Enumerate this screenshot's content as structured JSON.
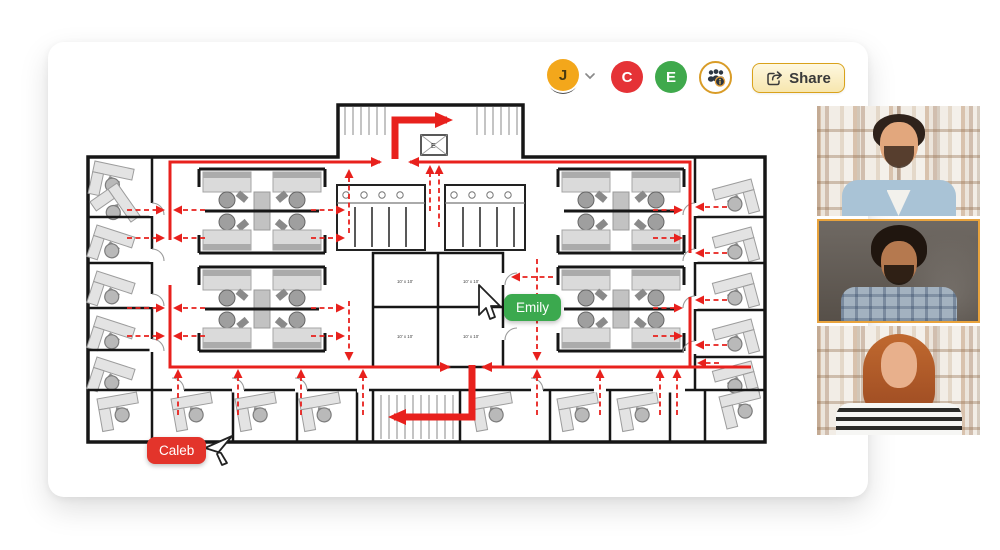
{
  "toolbar": {
    "user_avatar": {
      "initial": "J",
      "color": "#F3A71B"
    },
    "collaborators": [
      {
        "initial": "C",
        "color": "#E53236"
      },
      {
        "initial": "E",
        "color": "#3FA94C"
      }
    ],
    "share_label": "Share"
  },
  "cursors": {
    "emily": {
      "name": "Emily",
      "color": "#3BA94E"
    },
    "caleb": {
      "name": "Caleb",
      "color": "#E3342B"
    }
  },
  "floorplan": {
    "room_labels": {
      "top_left": "10' x 10'",
      "top_right": "10' x 10'",
      "bottom_left": "10' x 10'",
      "bottom_right": "10' x 10'"
    },
    "elevator_label": "E",
    "route_color": "#E8211D"
  },
  "video_call": {
    "participant_count": 3,
    "active_tile": 2,
    "active_border_color": "#E8A33D"
  }
}
